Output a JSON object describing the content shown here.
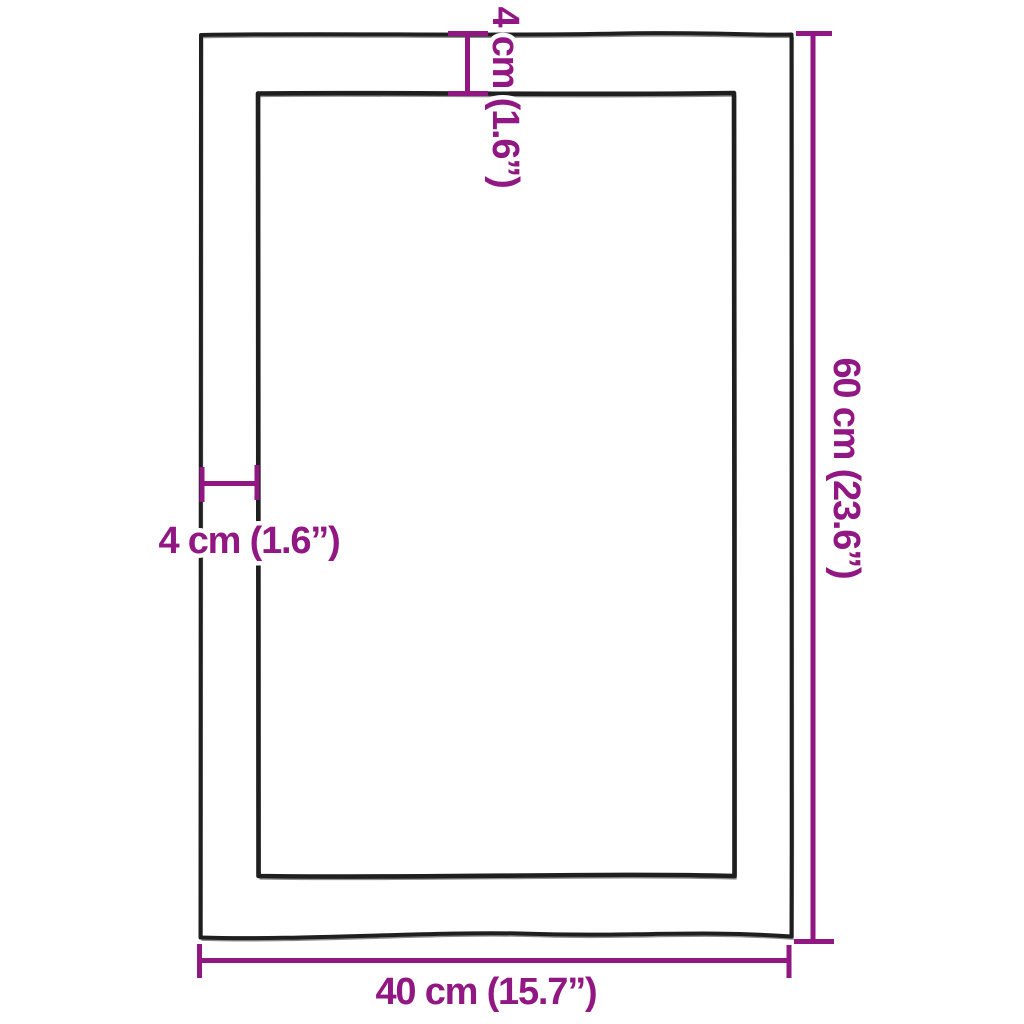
{
  "diagram": {
    "colors": {
      "dimension_accent": "#911783",
      "outline": "#1f1f1f",
      "background": "#ffffff"
    },
    "dimensions": {
      "top_border": {
        "label": "4 cm (1.6”)",
        "cm": 4,
        "inches": 1.6
      },
      "left_border": {
        "label": "4 cm (1.6”)",
        "cm": 4,
        "inches": 1.6
      },
      "height": {
        "label": "60 cm (23.6”)",
        "cm": 60,
        "inches": 23.6
      },
      "width": {
        "label": "40 cm (15.7”)",
        "cm": 40,
        "inches": 15.7
      }
    }
  }
}
